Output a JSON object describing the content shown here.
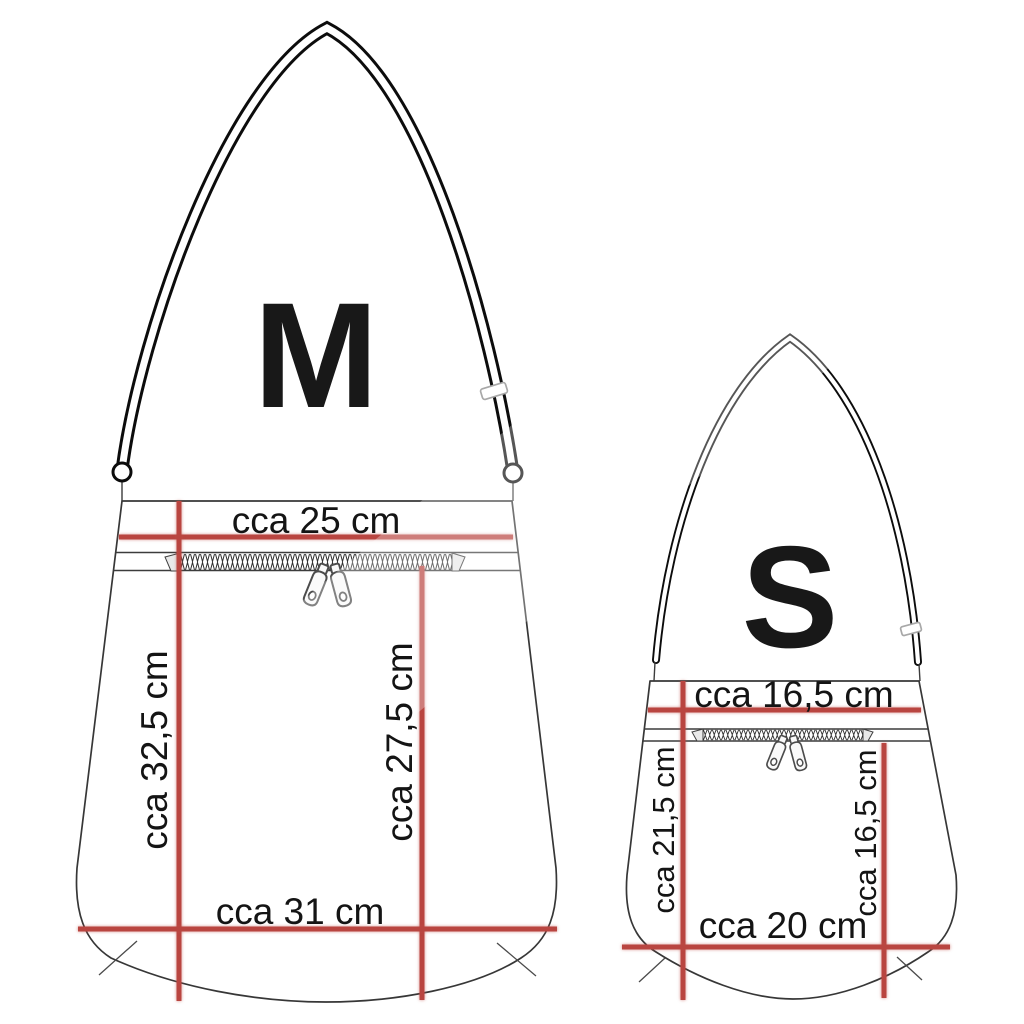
{
  "colors": {
    "measurement_red": "#b94540",
    "outline_gray": "#373737",
    "text_black": "#141414",
    "background": "#ffffff"
  },
  "bags": {
    "medium": {
      "size_label": "M",
      "opening_width_label": "cca 25 cm",
      "left_height_label": "cca 32,5 cm",
      "right_height_label": "cca 27,5 cm",
      "bottom_width_label": "cca 31 cm"
    },
    "small": {
      "size_label": "S",
      "opening_width_label": "cca 16,5 cm",
      "left_height_label": "cca 21,5 cm",
      "right_height_label": "cca 16,5 cm",
      "bottom_width_label": "cca 20 cm"
    }
  }
}
